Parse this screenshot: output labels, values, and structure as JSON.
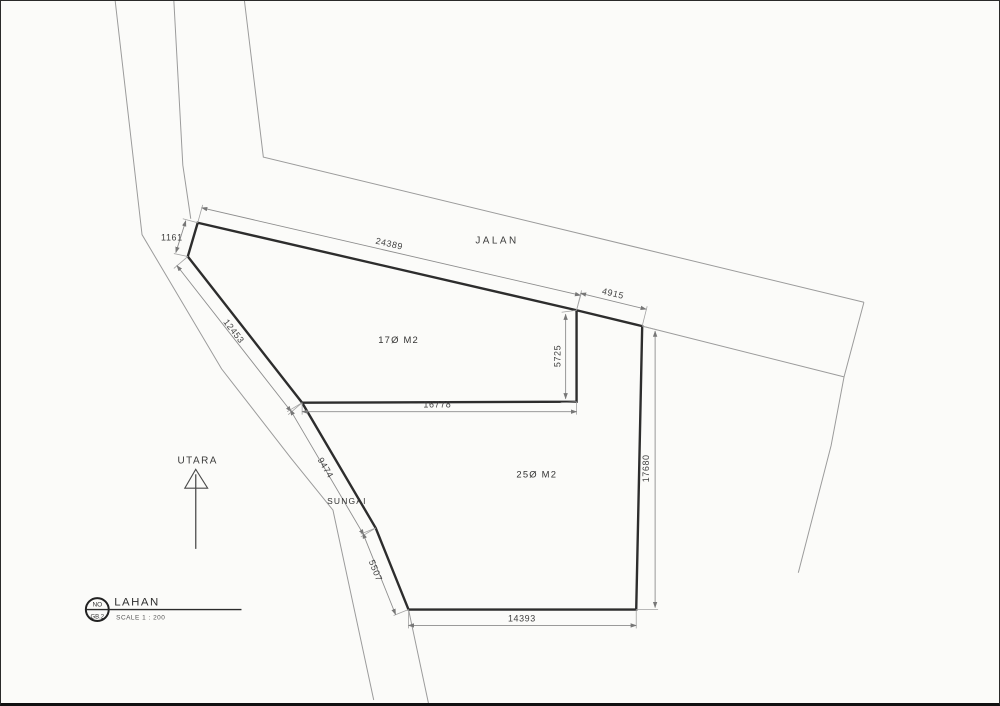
{
  "page": {
    "background": "#fbfbf9",
    "line_bold": "#2d2d2d",
    "line_thin": "#9b9b9b",
    "text_color": "#3f3f3f"
  },
  "plan": {
    "road_label": "JALAN",
    "river_label": "SUNGAI",
    "north_label": "UTARA",
    "parcel1_area": "17Ø M2",
    "parcel2_area": "25Ø M2",
    "dims": {
      "road_frontage": "24389",
      "road_frontage_2": "4915",
      "nw_kink": "1161",
      "west_upper": "12453",
      "river_mid": "9474",
      "river_lower": "5507",
      "divider_v": "5725",
      "divider_h": "16778",
      "east_side": "17680",
      "south_side": "14393"
    },
    "titleblock": {
      "bubble_top": "NO",
      "bubble_bottom": "GB.2",
      "title": "LAHAN",
      "scale": "SCALE 1 : 200"
    }
  }
}
